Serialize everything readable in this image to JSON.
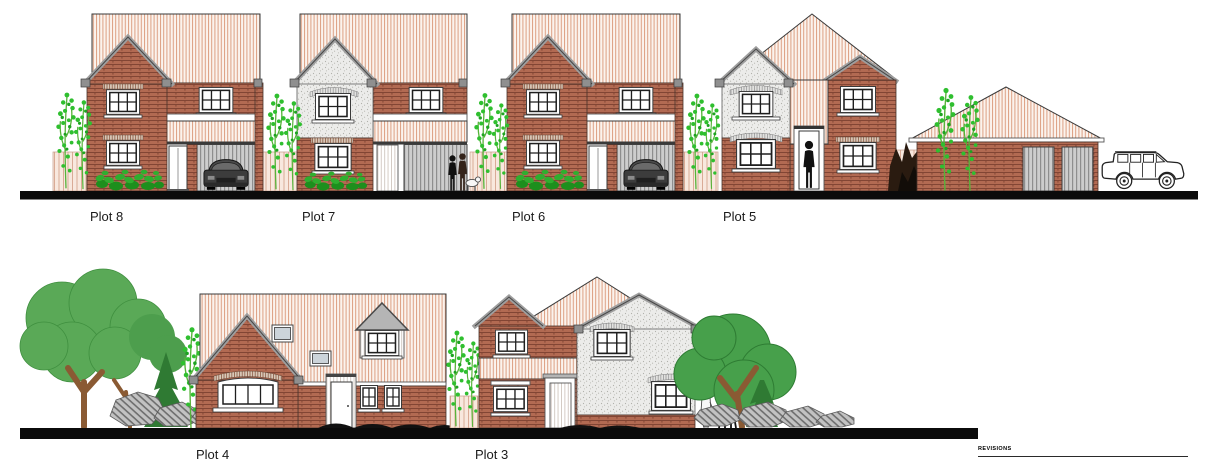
{
  "sheet": {
    "rows": {
      "top": {
        "plots": [
          {
            "label": "Plot 8"
          },
          {
            "label": "Plot 7"
          },
          {
            "label": "Plot 6"
          },
          {
            "label": "Plot 5"
          }
        ]
      },
      "bottom": {
        "plots": [
          {
            "label": "Plot 4"
          },
          {
            "label": "Plot 3"
          }
        ]
      }
    },
    "revisions": {
      "label": "REVISIONS"
    }
  },
  "palette": {
    "paper": "#ffffff",
    "ink": "#0b0b0b",
    "roof-bg": "#fbf3ed",
    "roof-stripe": "#dc9f82",
    "brick": "#b26a52",
    "brick-line": "#7c4130",
    "render": "#ececea",
    "render-dot": "#b1b1ab",
    "fence-bg": "#f8e8de",
    "fence-line": "#d9ab96",
    "garage-door": "#cdcdcd",
    "garage-line": "#8e8e8e",
    "barge": "#9e9e9e",
    "leaf": "#2fbf2f",
    "tree-light": "#5aa957",
    "tree-dark": "#47a04b",
    "trunk": "#8a5a33"
  }
}
